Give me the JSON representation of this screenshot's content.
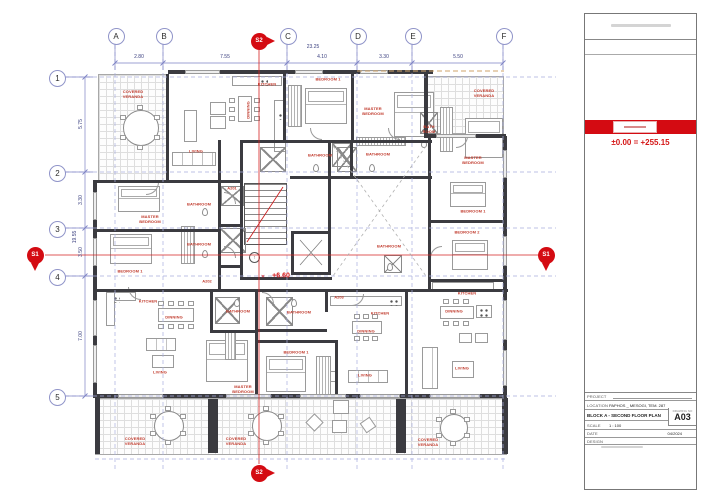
{
  "plan": {
    "grid_columns": [
      {
        "label": "A",
        "x": 115
      },
      {
        "label": "B",
        "x": 163
      },
      {
        "label": "C",
        "x": 287
      },
      {
        "label": "D",
        "x": 357
      },
      {
        "label": "E",
        "x": 412
      },
      {
        "label": "F",
        "x": 503
      }
    ],
    "grid_rows": [
      {
        "label": "1",
        "y": 77
      },
      {
        "label": "2",
        "y": 172
      },
      {
        "label": "3",
        "y": 228
      },
      {
        "label": "4",
        "y": 276
      },
      {
        "label": "5",
        "y": 396
      }
    ],
    "dim_top_total": "23.25",
    "dim_top": [
      {
        "v": "2.80",
        "x": 139
      },
      {
        "v": "7.55",
        "x": 225
      },
      {
        "v": "4.10",
        "x": 322
      },
      {
        "v": "3.30",
        "x": 384
      },
      {
        "v": "5.50",
        "x": 458
      }
    ],
    "dim_left_total": "19.55",
    "dim_left": [
      {
        "v": "5.75",
        "y": 124
      },
      {
        "v": "3.30",
        "y": 200
      },
      {
        "v": "3.50",
        "y": 252
      },
      {
        "v": "7.00",
        "y": 336
      }
    ],
    "markers": [
      {
        "label": "S2",
        "x": 259,
        "y": 41,
        "dir": "right"
      },
      {
        "label": "S2",
        "x": 259,
        "y": 473,
        "dir": "right"
      },
      {
        "label": "S1",
        "x": 35,
        "y": 255,
        "dir": "down"
      },
      {
        "label": "S1",
        "x": 546,
        "y": 255,
        "dir": "down"
      }
    ],
    "level_note": "+6.60",
    "units": [
      {
        "label": "A201",
        "x": 232,
        "y": 188
      },
      {
        "label": "A202",
        "x": 207,
        "y": 281
      },
      {
        "label": "A203",
        "x": 339,
        "y": 297
      }
    ],
    "rooms": [
      {
        "t": "COVERED\nVERANDA",
        "x": 133,
        "y": 95
      },
      {
        "t": "LIVING",
        "x": 196,
        "y": 152
      },
      {
        "t": "DINNING",
        "x": 249,
        "y": 110,
        "vert": true
      },
      {
        "t": "KITCHEN",
        "x": 267,
        "y": 85
      },
      {
        "t": "BEDROOM 1",
        "x": 328,
        "y": 80
      },
      {
        "t": "MASTER\nBEDROOM",
        "x": 373,
        "y": 112
      },
      {
        "t": "BATHROOM",
        "x": 320,
        "y": 156
      },
      {
        "t": "BATHROOM",
        "x": 378,
        "y": 155
      },
      {
        "t": "BATH\nROOM",
        "x": 429,
        "y": 130
      },
      {
        "t": "MASTER\nBEDROOM",
        "x": 473,
        "y": 161
      },
      {
        "t": "COVERED\nVERANDA",
        "x": 484,
        "y": 94
      },
      {
        "t": "MASTER\nBEDROOM",
        "x": 150,
        "y": 220
      },
      {
        "t": "BEDROOM 1",
        "x": 130,
        "y": 272
      },
      {
        "t": "BATHROOM",
        "x": 199,
        "y": 205
      },
      {
        "t": "BATHROOM",
        "x": 199,
        "y": 245
      },
      {
        "t": "BEDROOM 1",
        "x": 473,
        "y": 212
      },
      {
        "t": "BEDROOM 2",
        "x": 467,
        "y": 233
      },
      {
        "t": "BATHROOM",
        "x": 389,
        "y": 247
      },
      {
        "t": "KITCHEN",
        "x": 148,
        "y": 302
      },
      {
        "t": "DINNING",
        "x": 174,
        "y": 318
      },
      {
        "t": "LIVING",
        "x": 160,
        "y": 373
      },
      {
        "t": "BATHROOM",
        "x": 238,
        "y": 312
      },
      {
        "t": "MASTER\nBEDROOM",
        "x": 243,
        "y": 390
      },
      {
        "t": "BATHROOM",
        "x": 299,
        "y": 313
      },
      {
        "t": "BEDROOM 1",
        "x": 296,
        "y": 353
      },
      {
        "t": "KITCHEN",
        "x": 380,
        "y": 314
      },
      {
        "t": "DINNING",
        "x": 366,
        "y": 332
      },
      {
        "t": "LIVING",
        "x": 365,
        "y": 376
      },
      {
        "t": "KITCHEN",
        "x": 467,
        "y": 294
      },
      {
        "t": "DINNING",
        "x": 454,
        "y": 312
      },
      {
        "t": "LIVING",
        "x": 462,
        "y": 369
      },
      {
        "t": "COVERED\nVERANDA",
        "x": 135,
        "y": 442
      },
      {
        "t": "COVERED\nVERANDA",
        "x": 236,
        "y": 442
      },
      {
        "t": "COVERED\nVERANDA",
        "x": 428,
        "y": 443
      }
    ],
    "icons": {
      "stair_direction": "↑",
      "level_marker": "✕"
    }
  },
  "titleblock": {
    "datum_note": "±0.00 = +255.15",
    "project_label": "PROJECT",
    "location_label": "LOCATION",
    "location_value": "PAPHOS _ MESOGI, TEM. 287",
    "block_title": "BLOCK A - SECOND FLOOR PLAN",
    "scale_label": "SCALE",
    "scale_value": "1 : 100",
    "date_label": "DATE",
    "date_value": "04/2024",
    "design_label": "DESIGN",
    "drawing_no_label": "DRAWING NO",
    "drawing_no": "A03"
  }
}
